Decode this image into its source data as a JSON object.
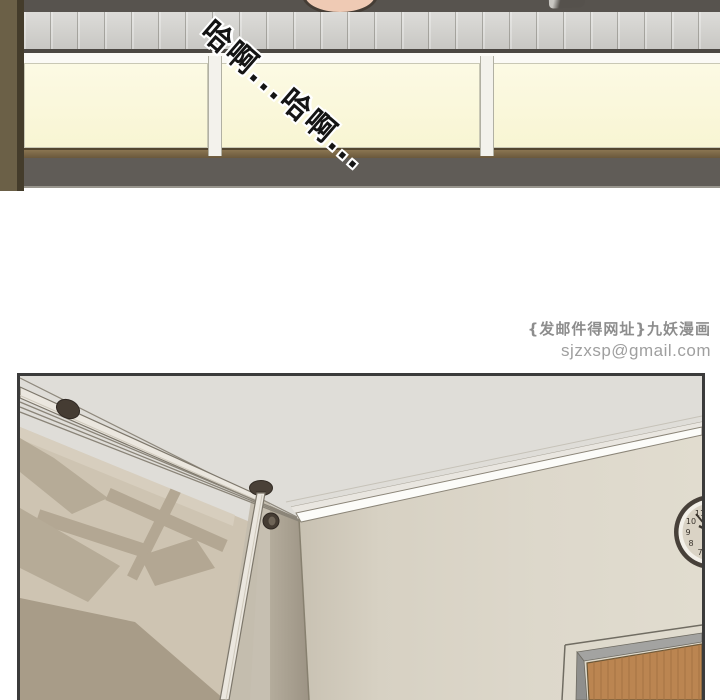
{
  "comic": {
    "top_panel": {
      "speech_bubble": "哈啊...哈啊...",
      "colors": {
        "counter_dark": "#57534e",
        "tile_strip": "#d3d2ce",
        "cabinet_cream": "#faf8dc",
        "ledge_brown": "#7d6848",
        "floor_gray": "#605c57",
        "wall_olive": "#6b6047",
        "skin": "#efcab4"
      }
    },
    "watermark": {
      "publisher_line": "{发邮件得网址}九妖漫画",
      "email": "sjzxsp@gmail.com"
    },
    "bottom_panel": {
      "clock_numbers": [
        "11",
        "10",
        "9",
        "8",
        "7"
      ],
      "colors": {
        "panel_border": "#3b3b3b",
        "ceiling": "#dfddd8",
        "right_wall": "#ddd8cb",
        "left_wall_tan": "#cec4b2",
        "shadow_tan": "#b3a793",
        "corner_strip": "#a39b8b",
        "pole_white": "#ebe7df",
        "knob_dark": "#453c33",
        "molding_white": "#fcfcf9",
        "door_wood": "#bb8551",
        "door_frame_gray": "#9a9a98",
        "clock_rim": "#474039",
        "clock_face": "#dad3c5"
      }
    }
  }
}
